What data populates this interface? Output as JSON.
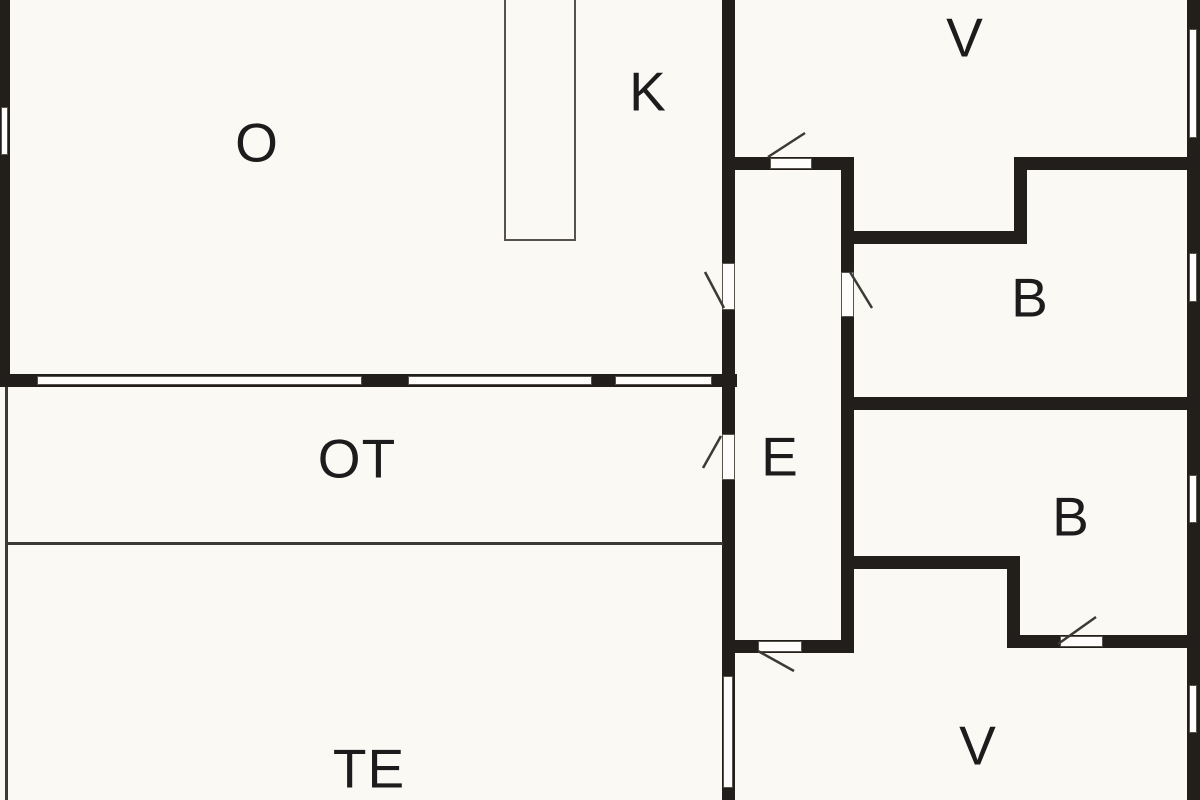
{
  "plan": {
    "title": "floor-plan",
    "canvas": {
      "width": 1200,
      "height": 800
    },
    "colors": {
      "background": "#faf9f4",
      "wall": "#211e1c",
      "thin_line": "#3d3935",
      "outline": "#57524b",
      "fill_white": "#fefdfb",
      "label": "#1c1c1c"
    },
    "rooms": [
      {
        "id": "o",
        "label": "O",
        "x": 257,
        "y": 143
      },
      {
        "id": "k",
        "label": "K",
        "x": 648,
        "y": 92
      },
      {
        "id": "v-top",
        "label": "V",
        "x": 965,
        "y": 38
      },
      {
        "id": "b-top",
        "label": "B",
        "x": 1030,
        "y": 298
      },
      {
        "id": "e",
        "label": "E",
        "x": 780,
        "y": 457
      },
      {
        "id": "ot",
        "label": "OT",
        "x": 357,
        "y": 459
      },
      {
        "id": "b-bottom",
        "label": "B",
        "x": 1071,
        "y": 517
      },
      {
        "id": "te",
        "label": "TE",
        "x": 369,
        "y": 769
      },
      {
        "id": "v-bottom",
        "label": "V",
        "x": 978,
        "y": 746
      }
    ],
    "walls": [
      {
        "name": "left-outer-wall",
        "x": 0,
        "y": 0,
        "w": 10,
        "h": 387
      },
      {
        "name": "o-south-wall",
        "x": 0,
        "y": 374,
        "w": 737,
        "h": 13
      },
      {
        "name": "k-e-wall",
        "x": 722,
        "y": 0,
        "w": 13,
        "h": 800
      },
      {
        "name": "v-e-wall",
        "x": 735,
        "y": 157,
        "w": 113,
        "h": 13
      },
      {
        "name": "e-east-wall",
        "x": 841,
        "y": 157,
        "w": 13,
        "h": 495
      },
      {
        "name": "b1-north-wall",
        "x": 848,
        "y": 231,
        "w": 172,
        "h": 13
      },
      {
        "name": "v-b1-step-wall",
        "x": 1014,
        "y": 157,
        "w": 13,
        "h": 87
      },
      {
        "name": "v-b1-east-wall",
        "x": 1014,
        "y": 157,
        "w": 186,
        "h": 13
      },
      {
        "name": "right-outer-wall",
        "x": 1187,
        "y": 0,
        "w": 13,
        "h": 800
      },
      {
        "name": "b1-south-wall",
        "x": 841,
        "y": 397,
        "w": 359,
        "h": 13
      },
      {
        "name": "b2-south-west-wall",
        "x": 848,
        "y": 556,
        "w": 172,
        "h": 13
      },
      {
        "name": "b2-step-wall",
        "x": 1007,
        "y": 556,
        "w": 13,
        "h": 92
      },
      {
        "name": "b2-south-east-wall",
        "x": 1007,
        "y": 635,
        "w": 193,
        "h": 13
      },
      {
        "name": "e-south-wall",
        "x": 735,
        "y": 640,
        "w": 119,
        "h": 13
      }
    ],
    "thin_lines": [
      {
        "name": "ot-west-line",
        "x": 5,
        "y": 387,
        "w": 3,
        "h": 413
      },
      {
        "name": "ot-te-line",
        "x": 5,
        "y": 542,
        "w": 718,
        "h": 3
      }
    ],
    "windows": [
      {
        "name": "o-west-window",
        "x": 1,
        "y": 107,
        "w": 7,
        "h": 48
      },
      {
        "name": "o-south-window-1",
        "x": 37,
        "y": 376,
        "w": 325,
        "h": 9
      },
      {
        "name": "o-south-window-2",
        "x": 408,
        "y": 376,
        "w": 184,
        "h": 9
      },
      {
        "name": "o-south-window-3",
        "x": 615,
        "y": 376,
        "w": 97,
        "h": 9
      },
      {
        "name": "v-east-window",
        "x": 1189,
        "y": 29,
        "w": 8,
        "h": 109
      },
      {
        "name": "b1-east-window",
        "x": 1189,
        "y": 253,
        "w": 8,
        "h": 49
      },
      {
        "name": "b2-east-window",
        "x": 1189,
        "y": 475,
        "w": 8,
        "h": 48
      },
      {
        "name": "v2-east-window",
        "x": 1189,
        "y": 685,
        "w": 8,
        "h": 48
      },
      {
        "name": "te-v-window",
        "x": 723,
        "y": 676,
        "w": 10,
        "h": 112
      }
    ],
    "door_leaves": [
      {
        "name": "door-leaf-k",
        "x": 722,
        "y": 263,
        "w": 13,
        "h": 47
      },
      {
        "name": "door-leaf-v",
        "x": 770,
        "y": 158,
        "w": 42,
        "h": 11
      },
      {
        "name": "door-leaf-b1",
        "x": 841,
        "y": 272,
        "w": 13,
        "h": 45
      },
      {
        "name": "door-leaf-ot",
        "x": 722,
        "y": 434,
        "w": 13,
        "h": 46
      },
      {
        "name": "door-leaf-v2",
        "x": 758,
        "y": 641,
        "w": 44,
        "h": 11
      },
      {
        "name": "door-leaf-b2",
        "x": 1060,
        "y": 636,
        "w": 43,
        "h": 11
      }
    ],
    "door_swings": [
      {
        "name": "door-swing-k",
        "x1": 705,
        "y1": 272,
        "x2": 724,
        "y2": 308
      },
      {
        "name": "door-swing-v",
        "x1": 768,
        "y1": 157,
        "x2": 805,
        "y2": 133
      },
      {
        "name": "door-swing-b1",
        "x1": 850,
        "y1": 272,
        "x2": 872,
        "y2": 308
      },
      {
        "name": "door-swing-ot",
        "x1": 721,
        "y1": 436,
        "x2": 703,
        "y2": 468
      },
      {
        "name": "door-swing-v2",
        "x1": 758,
        "y1": 651,
        "x2": 794,
        "y2": 671
      },
      {
        "name": "door-swing-b2",
        "x1": 1058,
        "y1": 644,
        "x2": 1096,
        "y2": 617
      }
    ],
    "furniture": [
      {
        "name": "kitchen-island",
        "x": 504,
        "y": -2,
        "w": 72,
        "h": 243
      }
    ]
  }
}
